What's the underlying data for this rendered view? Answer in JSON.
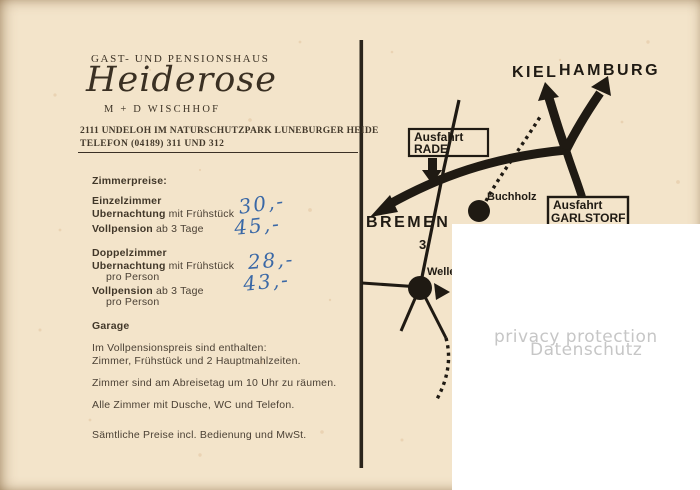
{
  "letterhead": {
    "type_line": "GAST- UND PENSIONSHAUS",
    "name": "Heiderose",
    "owners": "M + D  WISCHHOF",
    "address": "2111 UNDELOH IM NATURSCHUTZPARK LUNEBURGER HEIDE",
    "phone": "TELEFON (04189) 311 UND 312"
  },
  "price_list": {
    "heading": "Zimmerpreise:",
    "sections": [
      {
        "title": "Einzelzimmer",
        "rows": [
          {
            "bold": "Ubernachtung",
            "rest": "mit Frühstück",
            "sub": "",
            "price": "30,-"
          },
          {
            "bold": "Vollpension",
            "rest": "ab 3 Tage",
            "sub": "",
            "price": "45,-"
          }
        ]
      },
      {
        "title": "Doppelzimmer",
        "rows": [
          {
            "bold": "Ubernachtung",
            "rest": "mit Frühstück",
            "sub": "pro Person",
            "price": "28,-"
          },
          {
            "bold": "Vollpension",
            "rest": "ab 3 Tage",
            "sub": "pro Person",
            "price": "43,-"
          }
        ]
      }
    ],
    "garage": "Garage"
  },
  "notes": [
    "Im Vollpensionspreis sind enthalten:",
    "Zimmer, Frühstück und 2 Hauptmahlzeiten.",
    "Zimmer sind am Abreisetag um 10 Uhr zu räumen.",
    "Alle Zimmer mit Dusche, WC und Telefon.",
    "Sämtliche Preise incl. Bedienung und MwSt."
  ],
  "map": {
    "cities": {
      "kiel": "KIEL",
      "hamburg": "HAMBURG",
      "bremen": "BREMEN"
    },
    "signs": {
      "rade": [
        "Ausfahrt",
        "RADE"
      ],
      "garlstorf": [
        "Ausfahrt",
        "GARLSTORF"
      ]
    },
    "places": {
      "buchholz": "Buchholz",
      "welle": "Welle"
    },
    "road_number": "3"
  },
  "privacy": {
    "line1": "privacy protection",
    "line2": "Datenschutz"
  },
  "colors": {
    "paper": "#f3e4ca",
    "print_ink": "#3e3427",
    "map_ink": "#1f1a13",
    "handwriting_blue": "#3a68a6",
    "privacy_text": "#c6c6c6"
  }
}
